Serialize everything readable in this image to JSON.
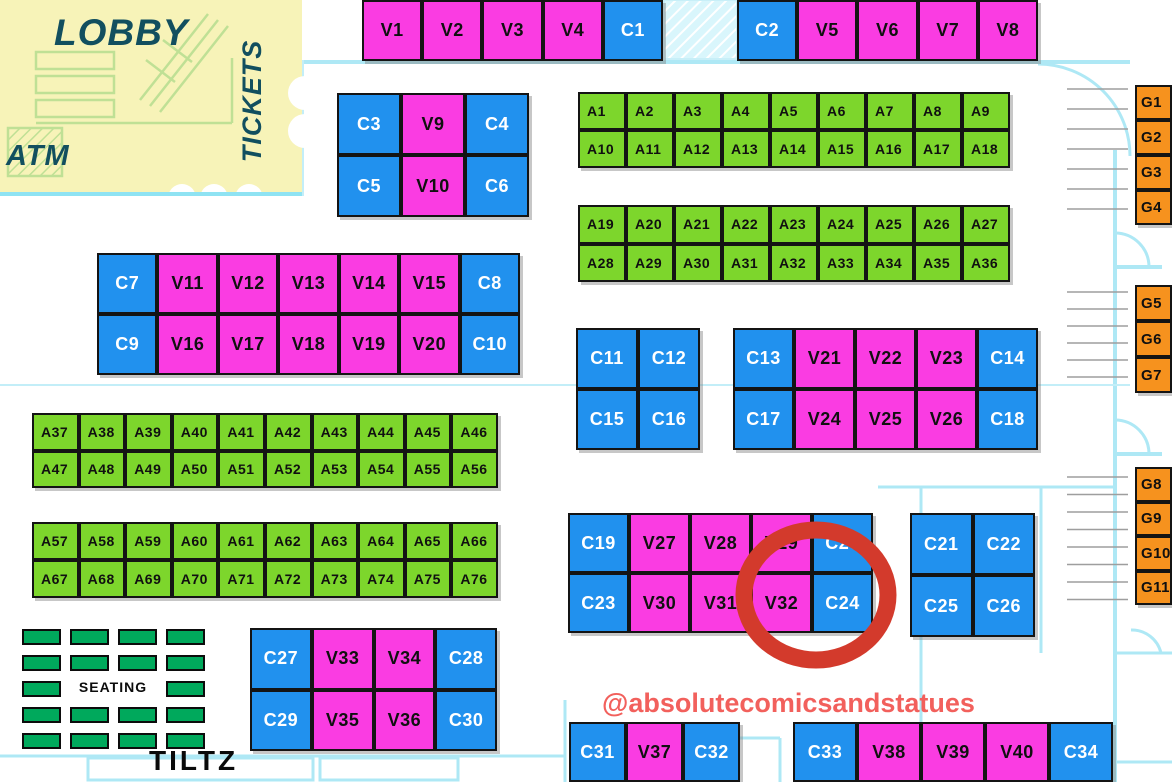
{
  "lobby": {
    "lobby_label": "LOBBY",
    "tickets_label": "TICKETS",
    "atm_label": "ATM"
  },
  "seating": {
    "label": "SEATING"
  },
  "tiltz_label": "TILTZ",
  "watermark": "@absolutecomicsandstatues",
  "highlighted_booth": "C24",
  "colors": {
    "vendor_magenta": "#FA3CE2",
    "exhibitor_blue": "#2191EE",
    "artist_green": "#7DD62C",
    "g_orange": "#F6921E",
    "seating_green": "#00A95C",
    "wall_cyan": "#AEE8F5",
    "lobby_yellow": "#F7F3B8",
    "lobby_sketch": "#BFE095",
    "label_teal": "#124F5F",
    "highlight_red": "#D33A2C",
    "watermark_salmon": "#F2605C",
    "booth_border": "#141414",
    "booth_text_dark": "#101010",
    "booth_text_light": "#FFFFFF",
    "stairs_gray": "#9E9E9E"
  },
  "blocks": [
    {
      "id": "top-left-row",
      "x": 362,
      "y": 0,
      "w": 301,
      "h": 61,
      "rows": [
        [
          "V1",
          "V2",
          "V3",
          "V4",
          "C1"
        ]
      ]
    },
    {
      "id": "top-right-row",
      "x": 737,
      "y": 0,
      "w": 301,
      "h": 61,
      "rows": [
        [
          "C2",
          "V5",
          "V6",
          "V7",
          "V8"
        ]
      ]
    },
    {
      "id": "c3-v9",
      "x": 337,
      "y": 93,
      "w": 192,
      "h": 124,
      "rows": [
        [
          "C3",
          "V9",
          "C4"
        ],
        [
          "C5",
          "V10",
          "C6"
        ]
      ]
    },
    {
      "id": "a1-a18",
      "x": 578,
      "y": 92,
      "w": 432,
      "h": 76,
      "rows": [
        [
          "A1",
          "A2",
          "A3",
          "A4",
          "A5",
          "A6",
          "A7",
          "A8",
          "A9"
        ],
        [
          "A10",
          "A11",
          "A12",
          "A13",
          "A14",
          "A15",
          "A16",
          "A17",
          "A18"
        ]
      ]
    },
    {
      "id": "a19-a36",
      "x": 578,
      "y": 205,
      "w": 432,
      "h": 77,
      "rows": [
        [
          "A19",
          "A20",
          "A21",
          "A22",
          "A23",
          "A24",
          "A25",
          "A26",
          "A27"
        ],
        [
          "A28",
          "A29",
          "A30",
          "A31",
          "A32",
          "A33",
          "A34",
          "A35",
          "A36"
        ]
      ]
    },
    {
      "id": "c7-v11",
      "x": 97,
      "y": 253,
      "w": 423,
      "h": 122,
      "rows": [
        [
          "C7",
          "V11",
          "V12",
          "V13",
          "V14",
          "V15",
          "C8"
        ],
        [
          "C9",
          "V16",
          "V17",
          "V18",
          "V19",
          "V20",
          "C10"
        ]
      ]
    },
    {
      "id": "c11-c16",
      "x": 576,
      "y": 328,
      "w": 124,
      "h": 122,
      "rows": [
        [
          "C11",
          "C12"
        ],
        [
          "C15",
          "C16"
        ]
      ]
    },
    {
      "id": "c13-v21",
      "x": 733,
      "y": 328,
      "w": 305,
      "h": 122,
      "rows": [
        [
          "C13",
          "V21",
          "V22",
          "V23",
          "C14"
        ],
        [
          "C17",
          "V24",
          "V25",
          "V26",
          "C18"
        ]
      ]
    },
    {
      "id": "a37-a56",
      "x": 32,
      "y": 413,
      "w": 466,
      "h": 75,
      "rows": [
        [
          "A37",
          "A38",
          "A39",
          "A40",
          "A41",
          "A42",
          "A43",
          "A44",
          "A45",
          "A46"
        ],
        [
          "A47",
          "A48",
          "A49",
          "A50",
          "A51",
          "A52",
          "A53",
          "A54",
          "A55",
          "A56"
        ]
      ]
    },
    {
      "id": "a57-a76",
      "x": 32,
      "y": 522,
      "w": 466,
      "h": 76,
      "rows": [
        [
          "A57",
          "A58",
          "A59",
          "A60",
          "A61",
          "A62",
          "A63",
          "A64",
          "A65",
          "A66"
        ],
        [
          "A67",
          "A68",
          "A69",
          "A70",
          "A71",
          "A72",
          "A73",
          "A74",
          "A75",
          "A76"
        ]
      ]
    },
    {
      "id": "c19-v27",
      "x": 568,
      "y": 513,
      "w": 305,
      "h": 120,
      "rows": [
        [
          "C19",
          "V27",
          "V28",
          "V29",
          "C20"
        ],
        [
          "C23",
          "V30",
          "V31",
          "V32",
          "C24"
        ]
      ]
    },
    {
      "id": "c21-c26",
      "x": 910,
      "y": 513,
      "w": 125,
      "h": 124,
      "rows": [
        [
          "C21",
          "C22"
        ],
        [
          "C25",
          "C26"
        ]
      ]
    },
    {
      "id": "c27-v33",
      "x": 250,
      "y": 628,
      "w": 247,
      "h": 123,
      "rows": [
        [
          "C27",
          "V33",
          "V34",
          "C28"
        ],
        [
          "C29",
          "V35",
          "V36",
          "C30"
        ]
      ]
    },
    {
      "id": "c31-v37",
      "x": 569,
      "y": 722,
      "w": 171,
      "h": 60,
      "rows": [
        [
          "C31",
          "V37",
          "C32"
        ]
      ]
    },
    {
      "id": "c33-v38",
      "x": 793,
      "y": 722,
      "w": 320,
      "h": 60,
      "rows": [
        [
          "C33",
          "V38",
          "V39",
          "V40",
          "C34"
        ]
      ]
    },
    {
      "id": "g1-g4",
      "x": 1135,
      "y": 85,
      "w": 37,
      "h": 140,
      "rows": [
        [
          "G1"
        ],
        [
          "G2"
        ],
        [
          "G3"
        ],
        [
          "G4"
        ]
      ]
    },
    {
      "id": "g5-g7",
      "x": 1135,
      "y": 285,
      "w": 37,
      "h": 108,
      "rows": [
        [
          "G5"
        ],
        [
          "G6"
        ],
        [
          "G7"
        ]
      ]
    },
    {
      "id": "g8-g11",
      "x": 1135,
      "y": 467,
      "w": 37,
      "h": 138,
      "rows": [
        [
          "G8"
        ],
        [
          "G9"
        ],
        [
          "G10"
        ],
        [
          "G11"
        ]
      ]
    }
  ]
}
